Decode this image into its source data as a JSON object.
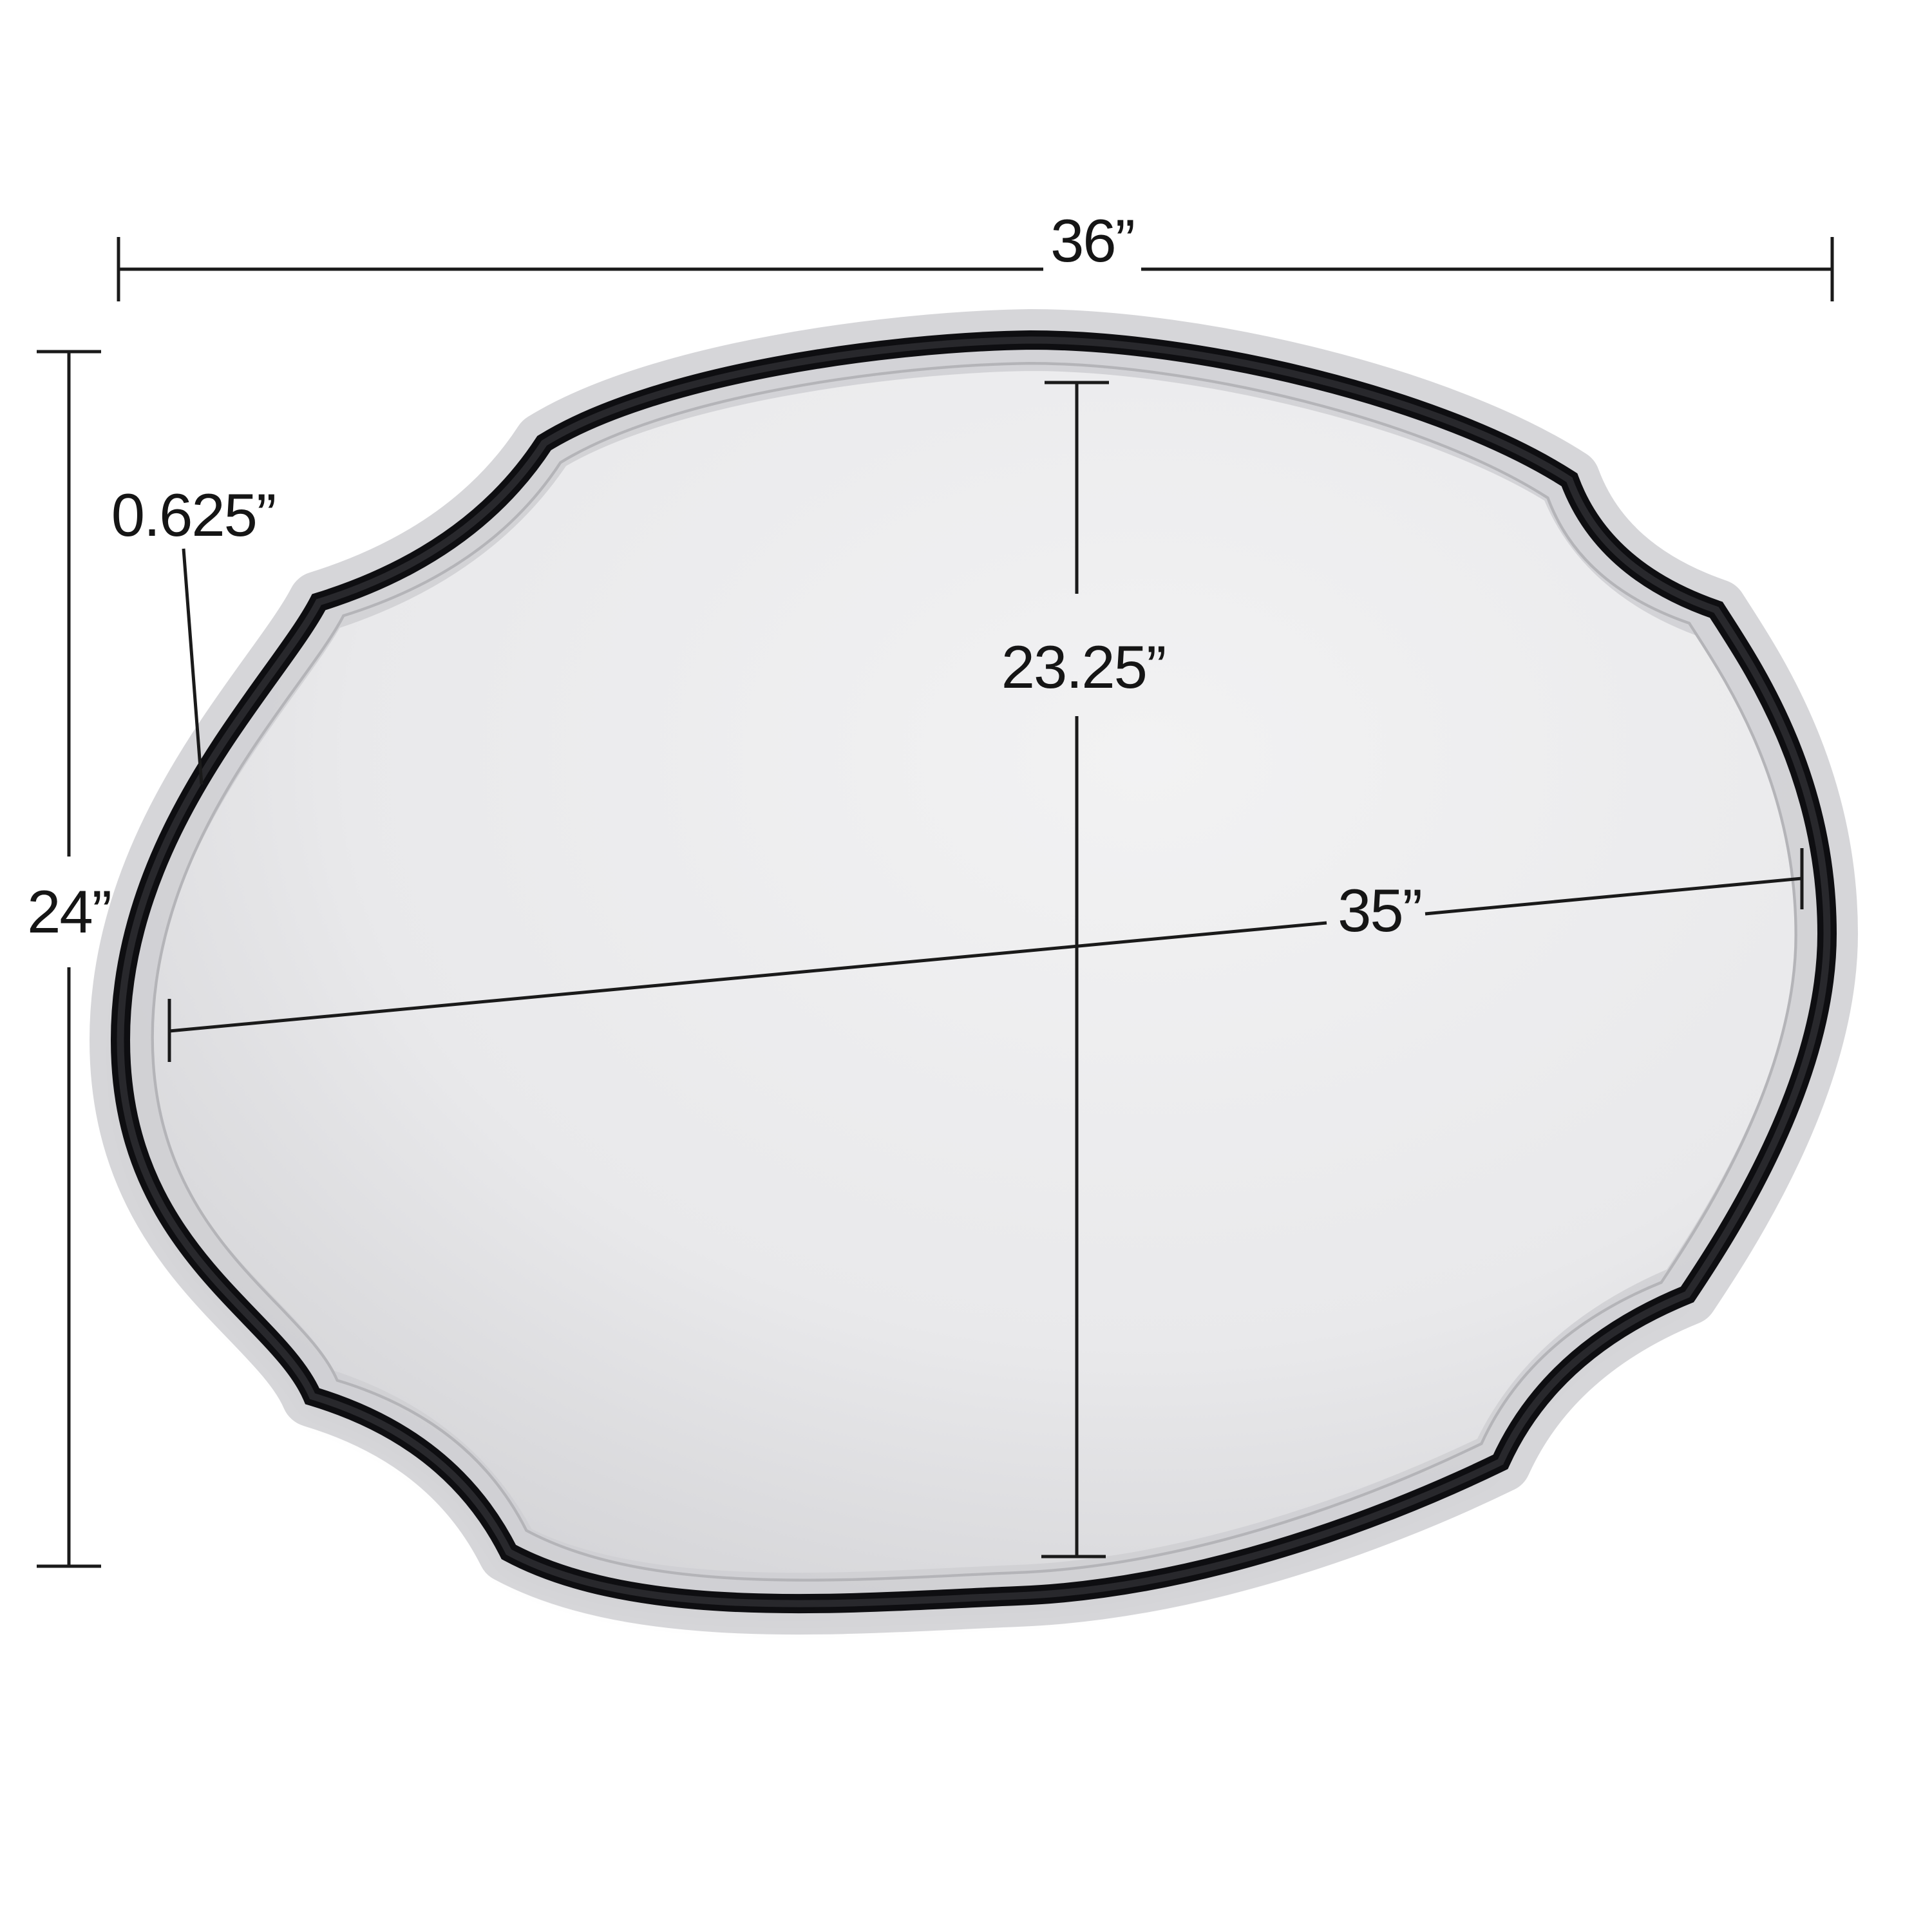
{
  "diagram_type": "product-dimension-diagram",
  "product": "scalloped-oval-wall-mirror",
  "labels": {
    "overall_width": "36”",
    "overall_height": "24”",
    "frame_thickness": "0.625”",
    "mirror_glass_height": "23.25”",
    "mirror_glass_width": "35”"
  },
  "colors": {
    "background": "#ffffff",
    "frame": "#0e0e11",
    "frame_inner": "#2b2b30",
    "glass_center": "#f2f2f3",
    "glass_mid": "#e9e9eb",
    "glass_edge": "#d5d5d8",
    "bevel_band": "#cfcfd2",
    "bevel_line": "#b4b4b8",
    "dimension_line": "#1a1a1a",
    "label_text": "#151515"
  }
}
